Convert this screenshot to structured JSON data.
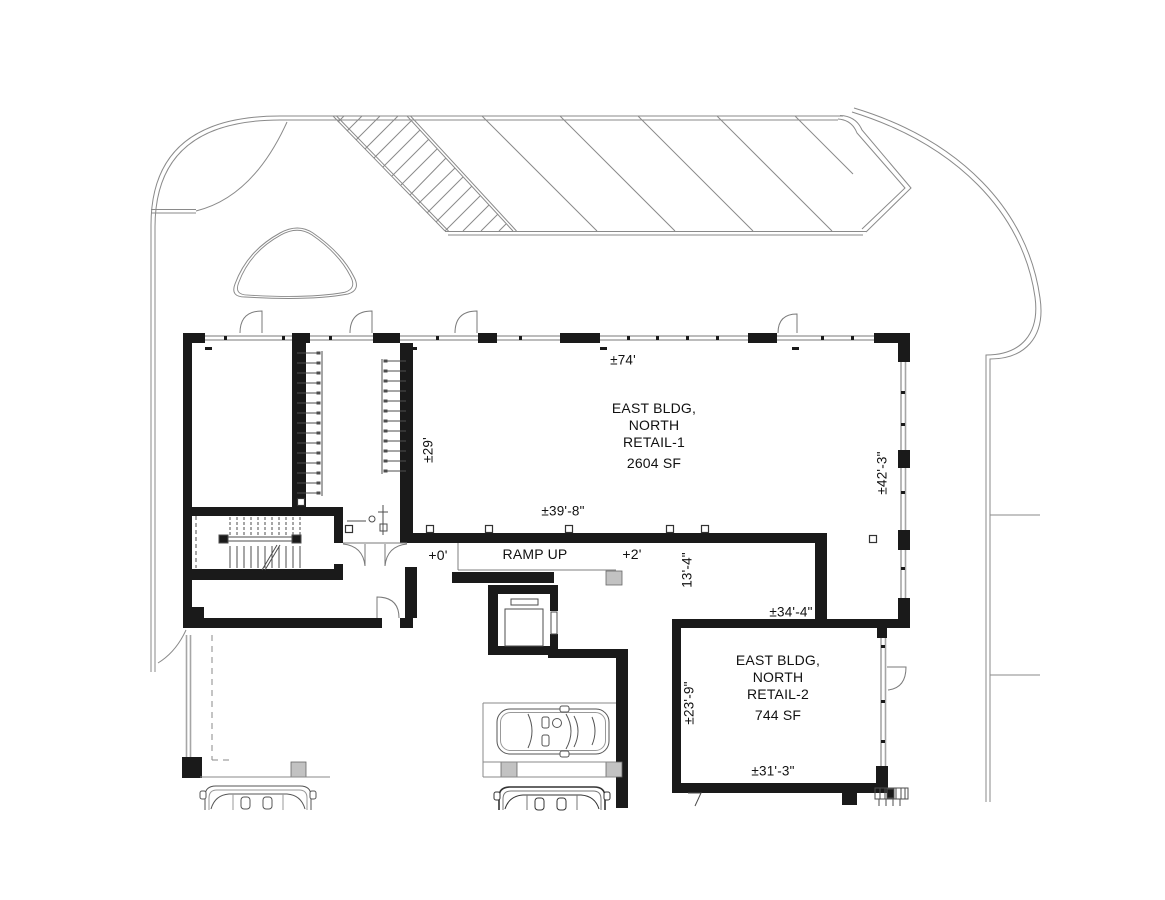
{
  "drawing": {
    "type": "architectural-floor-plan",
    "rooms": {
      "retail1": {
        "name_line1": "EAST BLDG,",
        "name_line2": "NORTH",
        "name_line3": "RETAIL-1",
        "area": "2604 SF"
      },
      "retail2": {
        "name_line1": "EAST BLDG,",
        "name_line2": "NORTH",
        "name_line3": "RETAIL-2",
        "area": "744 SF"
      }
    },
    "ramp": {
      "label": "RAMP UP",
      "start_elevation": "+0'",
      "end_elevation": "+2'"
    },
    "dimensions": {
      "retail1_top_width": "±74'",
      "retail1_left_height": "±29'",
      "retail1_interior_width": "±39'-8\"",
      "retail1_right_height": "±42'-3\"",
      "retail1_bottom_width": "±34'-4\"",
      "retail1_step_height": "13'-4\"",
      "retail2_left_height": "±23'-9\"",
      "retail2_bottom_width": "±31'-3\""
    },
    "colors": {
      "wall": "#1a1a1a",
      "thin_line": "#7f7f7f",
      "glazing": "#a6a6a6",
      "column_fill": "#c2c2c2",
      "text": "#111111"
    }
  }
}
